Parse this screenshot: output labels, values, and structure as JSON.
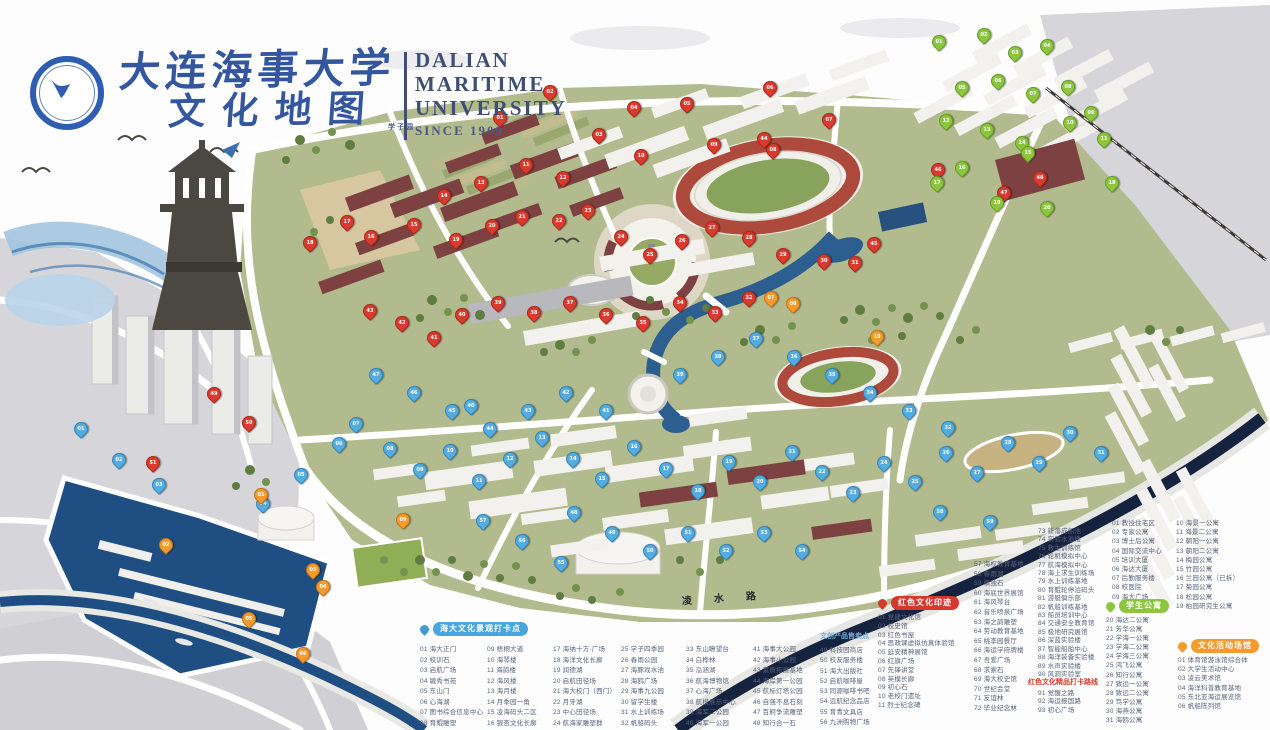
{
  "header": {
    "title_cn_1": "大连海事大学",
    "title_cn_2": "文化地图",
    "en1": "DALIAN",
    "en2": "MARITIME",
    "en3": "UNIVERSITY",
    "since": "SINCE 1909"
  },
  "map": {
    "road_label": "凌水路",
    "area_label": "学子园",
    "accent_colors": {
      "red_pin": "#d93b2f",
      "blue_pin": "#55ace0",
      "green_pin": "#8cc63f",
      "orange_pin": "#f59b2d",
      "water": "#2d5e90",
      "track": "#ad4a3c"
    },
    "pins": [
      {
        "t": "r",
        "x": 499,
        "y": 126
      },
      {
        "t": "r",
        "x": 549,
        "y": 100
      },
      {
        "t": "r",
        "x": 598,
        "y": 143
      },
      {
        "t": "r",
        "x": 633,
        "y": 116
      },
      {
        "t": "r",
        "x": 686,
        "y": 112
      },
      {
        "t": "r",
        "x": 769,
        "y": 96
      },
      {
        "t": "r",
        "x": 828,
        "y": 128
      },
      {
        "t": "r",
        "x": 772,
        "y": 158
      },
      {
        "t": "r",
        "x": 713,
        "y": 153
      },
      {
        "t": "r",
        "x": 640,
        "y": 164
      },
      {
        "t": "r",
        "x": 525,
        "y": 173
      },
      {
        "t": "r",
        "x": 562,
        "y": 186
      },
      {
        "t": "r",
        "x": 480,
        "y": 191
      },
      {
        "t": "r",
        "x": 443,
        "y": 204
      },
      {
        "t": "r",
        "x": 413,
        "y": 233
      },
      {
        "t": "r",
        "x": 370,
        "y": 245
      },
      {
        "t": "r",
        "x": 346,
        "y": 230
      },
      {
        "t": "r",
        "x": 309,
        "y": 251
      },
      {
        "t": "r",
        "x": 455,
        "y": 248
      },
      {
        "t": "r",
        "x": 491,
        "y": 234
      },
      {
        "t": "r",
        "x": 521,
        "y": 225
      },
      {
        "t": "r",
        "x": 558,
        "y": 229
      },
      {
        "t": "r",
        "x": 587,
        "y": 219
      },
      {
        "t": "r",
        "x": 620,
        "y": 245
      },
      {
        "t": "r",
        "x": 649,
        "y": 263
      },
      {
        "t": "r",
        "x": 681,
        "y": 249
      },
      {
        "t": "r",
        "x": 711,
        "y": 236
      },
      {
        "t": "r",
        "x": 748,
        "y": 246
      },
      {
        "t": "r",
        "x": 782,
        "y": 263
      },
      {
        "t": "r",
        "x": 823,
        "y": 269
      },
      {
        "t": "r",
        "x": 854,
        "y": 271
      },
      {
        "t": "r",
        "x": 748,
        "y": 306
      },
      {
        "t": "r",
        "x": 714,
        "y": 321
      },
      {
        "t": "r",
        "x": 679,
        "y": 311
      },
      {
        "t": "r",
        "x": 642,
        "y": 331
      },
      {
        "t": "r",
        "x": 605,
        "y": 323
      },
      {
        "t": "r",
        "x": 569,
        "y": 311
      },
      {
        "t": "r",
        "x": 533,
        "y": 321
      },
      {
        "t": "r",
        "x": 497,
        "y": 311
      },
      {
        "t": "r",
        "x": 461,
        "y": 323
      },
      {
        "t": "r",
        "x": 433,
        "y": 346
      },
      {
        "t": "r",
        "x": 401,
        "y": 331
      },
      {
        "t": "r",
        "x": 369,
        "y": 319
      },
      {
        "t": "r",
        "x": 763,
        "y": 147
      },
      {
        "t": "r",
        "x": 873,
        "y": 252
      },
      {
        "t": "r",
        "x": 937,
        "y": 178
      },
      {
        "t": "r",
        "x": 1003,
        "y": 201
      },
      {
        "t": "r",
        "x": 1039,
        "y": 186
      },
      {
        "t": "r",
        "x": 213,
        "y": 402
      },
      {
        "t": "r",
        "x": 248,
        "y": 431
      },
      {
        "t": "r",
        "x": 152,
        "y": 471
      },
      {
        "t": "b",
        "x": 80,
        "y": 437
      },
      {
        "t": "b",
        "x": 118,
        "y": 468
      },
      {
        "t": "b",
        "x": 158,
        "y": 493
      },
      {
        "t": "b",
        "x": 262,
        "y": 512
      },
      {
        "t": "b",
        "x": 300,
        "y": 483
      },
      {
        "t": "b",
        "x": 338,
        "y": 452
      },
      {
        "t": "b",
        "x": 355,
        "y": 432
      },
      {
        "t": "b",
        "x": 389,
        "y": 457
      },
      {
        "t": "b",
        "x": 419,
        "y": 478
      },
      {
        "t": "b",
        "x": 449,
        "y": 459
      },
      {
        "t": "b",
        "x": 478,
        "y": 489
      },
      {
        "t": "b",
        "x": 509,
        "y": 467
      },
      {
        "t": "b",
        "x": 541,
        "y": 446
      },
      {
        "t": "b",
        "x": 572,
        "y": 467
      },
      {
        "t": "b",
        "x": 601,
        "y": 487
      },
      {
        "t": "b",
        "x": 633,
        "y": 455
      },
      {
        "t": "b",
        "x": 665,
        "y": 477
      },
      {
        "t": "b",
        "x": 697,
        "y": 499
      },
      {
        "t": "b",
        "x": 728,
        "y": 470
      },
      {
        "t": "b",
        "x": 759,
        "y": 490
      },
      {
        "t": "b",
        "x": 791,
        "y": 460
      },
      {
        "t": "b",
        "x": 821,
        "y": 480
      },
      {
        "t": "b",
        "x": 852,
        "y": 501
      },
      {
        "t": "b",
        "x": 883,
        "y": 471
      },
      {
        "t": "b",
        "x": 914,
        "y": 490
      },
      {
        "t": "b",
        "x": 945,
        "y": 461
      },
      {
        "t": "b",
        "x": 976,
        "y": 481
      },
      {
        "t": "b",
        "x": 1007,
        "y": 451
      },
      {
        "t": "b",
        "x": 1038,
        "y": 471
      },
      {
        "t": "b",
        "x": 1069,
        "y": 441
      },
      {
        "t": "b",
        "x": 1100,
        "y": 461
      },
      {
        "t": "b",
        "x": 947,
        "y": 436
      },
      {
        "t": "b",
        "x": 908,
        "y": 419
      },
      {
        "t": "b",
        "x": 869,
        "y": 401
      },
      {
        "t": "b",
        "x": 831,
        "y": 383
      },
      {
        "t": "b",
        "x": 793,
        "y": 365
      },
      {
        "t": "b",
        "x": 755,
        "y": 347
      },
      {
        "t": "b",
        "x": 717,
        "y": 365
      },
      {
        "t": "b",
        "x": 679,
        "y": 383
      },
      {
        "t": "b",
        "x": 470,
        "y": 414
      },
      {
        "t": "b",
        "x": 605,
        "y": 419
      },
      {
        "t": "b",
        "x": 565,
        "y": 401
      },
      {
        "t": "b",
        "x": 527,
        "y": 419
      },
      {
        "t": "b",
        "x": 489,
        "y": 437
      },
      {
        "t": "b",
        "x": 451,
        "y": 419
      },
      {
        "t": "b",
        "x": 413,
        "y": 401
      },
      {
        "t": "b",
        "x": 375,
        "y": 383
      },
      {
        "t": "b",
        "x": 573,
        "y": 521
      },
      {
        "t": "b",
        "x": 611,
        "y": 541
      },
      {
        "t": "b",
        "x": 649,
        "y": 559
      },
      {
        "t": "b",
        "x": 687,
        "y": 541
      },
      {
        "t": "b",
        "x": 725,
        "y": 559
      },
      {
        "t": "b",
        "x": 763,
        "y": 541
      },
      {
        "t": "b",
        "x": 801,
        "y": 559
      },
      {
        "t": "b",
        "x": 560,
        "y": 571
      },
      {
        "t": "b",
        "x": 521,
        "y": 549
      },
      {
        "t": "b",
        "x": 482,
        "y": 529
      },
      {
        "t": "b",
        "x": 939,
        "y": 520
      },
      {
        "t": "b",
        "x": 989,
        "y": 530
      },
      {
        "t": "g",
        "x": 938,
        "y": 50
      },
      {
        "t": "g",
        "x": 983,
        "y": 43
      },
      {
        "t": "g",
        "x": 1014,
        "y": 61
      },
      {
        "t": "g",
        "x": 1046,
        "y": 54
      },
      {
        "t": "g",
        "x": 961,
        "y": 96
      },
      {
        "t": "g",
        "x": 997,
        "y": 89
      },
      {
        "t": "g",
        "x": 1032,
        "y": 102
      },
      {
        "t": "g",
        "x": 1067,
        "y": 95
      },
      {
        "t": "g",
        "x": 1090,
        "y": 121
      },
      {
        "t": "g",
        "x": 1069,
        "y": 131
      },
      {
        "t": "g",
        "x": 1103,
        "y": 147
      },
      {
        "t": "g",
        "x": 945,
        "y": 129
      },
      {
        "t": "g",
        "x": 986,
        "y": 138
      },
      {
        "t": "g",
        "x": 1021,
        "y": 151
      },
      {
        "t": "g",
        "x": 1027,
        "y": 161
      },
      {
        "t": "g",
        "x": 961,
        "y": 176
      },
      {
        "t": "g",
        "x": 936,
        "y": 191
      },
      {
        "t": "g",
        "x": 1111,
        "y": 191
      },
      {
        "t": "g",
        "x": 996,
        "y": 211
      },
      {
        "t": "g",
        "x": 1046,
        "y": 216
      },
      {
        "t": "o",
        "x": 260,
        "y": 503
      },
      {
        "t": "o",
        "x": 165,
        "y": 553
      },
      {
        "t": "o",
        "x": 312,
        "y": 578
      },
      {
        "t": "o",
        "x": 322,
        "y": 595
      },
      {
        "t": "o",
        "x": 248,
        "y": 627
      },
      {
        "t": "o",
        "x": 302,
        "y": 662
      },
      {
        "t": "o",
        "x": 770,
        "y": 306
      },
      {
        "t": "o",
        "x": 792,
        "y": 312
      },
      {
        "t": "o",
        "x": 402,
        "y": 528
      },
      {
        "t": "o",
        "x": 876,
        "y": 345
      }
    ]
  },
  "legend": {
    "blocks": [
      {
        "type": "badge",
        "style": "blue",
        "x": 420,
        "y": 622,
        "text": "海大文化景观打卡点"
      },
      {
        "type": "column",
        "x": 420,
        "y": 645,
        "lh": 10.5,
        "items": [
          "01 海大正门",
          "02 校训石",
          "03 启航广场",
          "04 毓秀书苑",
          "05 东山门",
          "06 心海湖",
          "07 图书综合信息中心",
          "08 育鲲雕塑"
        ]
      },
      {
        "type": "column",
        "x": 487,
        "y": 645,
        "lh": 10.5,
        "items": [
          "09 梧桐大道",
          "10 海琴楼",
          "11 海韵楼",
          "12 海风楼",
          "13 海月楼",
          "14 月季园一角",
          "15 凌海码头二区",
          "16 银杏文化长廊"
        ]
      },
      {
        "type": "column",
        "x": 553,
        "y": 645,
        "lh": 10.5,
        "items": [
          "17 海纳十方·广场",
          "18 海洋文化长廊",
          "19 润德湖",
          "20 启航田径场",
          "21 海大校门（西门）",
          "22 月牙湖",
          "23 中心田径场",
          "24 航海家雕塑群"
        ]
      },
      {
        "type": "column",
        "x": 621,
        "y": 645,
        "lh": 10.5,
        "items": [
          "25 学子四季园",
          "26 春雨公园",
          "27 海豚戏水池",
          "28 海鸥广场",
          "29 海事九公园",
          "30 留学生楼",
          "31 水上训练场",
          "32 帆船码头"
        ]
      },
      {
        "type": "column",
        "x": 686,
        "y": 645,
        "lh": 10.5,
        "items": [
          "33 东山瞭望台",
          "34 白桦林",
          "35 泓涵湖",
          "36 航海博物馆",
          "37 心海广场",
          "38 航模展示中心",
          "39 海军二公园",
          "40 海军一公园"
        ]
      },
      {
        "type": "column",
        "x": 753,
        "y": 645,
        "lh": 10.5,
        "items": [
          "41 海事大公园",
          "42 海事小公园",
          "43 素质拓展基地",
          "44 海岸第一公园",
          "45 航标灯塔公园",
          "46 自强不息石刻",
          "47 百舸争流雕塑",
          "48 知行合一石"
        ]
      },
      {
        "type": "subheader",
        "style": "blueText",
        "x": 820,
        "y": 633,
        "text": "文创产品售卖点"
      },
      {
        "type": "column",
        "x": 820,
        "y": 646,
        "lh": 10.3,
        "items": [
          "49 科技园商店",
          "50 校友服务楼",
          "51 海大出版社",
          "52 启航咖啡屋",
          "53 同源咖啡书吧",
          "54 远航纪念品店",
          "55 育青文具店",
          "56 九洲购物广场"
        ]
      },
      {
        "type": "column",
        "x": 974,
        "y": 560,
        "lh": 9.6,
        "items": [
          "57 海权教育基地",
          "58 春雨湖",
          "59 慎独石",
          "60 海底世界展馆",
          "61 海风琴台",
          "62 音乐喷泉广场",
          "63 海之韵雕塑",
          "64 劳动教育基地",
          "65 桃李园餐厅",
          "66 海运学府牌楼",
          "67 吾爱广场",
          "68 求索石",
          "69 海大校史馆",
          "70 世纪会堂",
          "71 友谊林",
          "72 毕业纪念林"
        ]
      },
      {
        "type": "column",
        "x": 1038,
        "y": 528,
        "lh": 8.4,
        "items": [
          "73 新落成船池",
          "74 实验水池楼",
          "75 救生训练馆",
          "76 轮机模拟中心",
          "77 航海模拟中心",
          "78 海上求生训练场",
          "79 水上训练基地",
          "80 育鲲轮停泊码头",
          "81 游艇俱乐部",
          "82 帆船训练基地",
          "83 船员培训中心",
          "84 交通安全教育馆",
          "85 极地研究展馆",
          "86 深蓝实验楼",
          "87 智能船舶中心",
          "88 海洋装备实验楼",
          "89 水声实验楼",
          "90 风洞实验室"
        ]
      },
      {
        "type": "subheader",
        "style": "redText",
        "x": 1028,
        "y": 679,
        "text": "红色文化精品打卡路线"
      },
      {
        "type": "column",
        "x": 1038,
        "y": 690,
        "lh": 8.3,
        "items": [
          "91 觉醒之路",
          "92 海运报国路",
          "93 初心广场"
        ]
      },
      {
        "type": "badge",
        "style": "red",
        "x": 878,
        "y": 596,
        "text": "红色文化印迹"
      },
      {
        "type": "column",
        "x": 878,
        "y": 614,
        "lh": 8.8,
        "items": [
          "01 党建文化馆",
          "02 校史馆",
          "03 红色书屋",
          "04 思政课虚拟仿真体验馆",
          "05 延安精神展馆",
          "06 红旗广场",
          "07 先锋讲堂",
          "08 英模长廊",
          "09 初心石",
          "10 老校门遗址",
          "11 烈士纪念碑"
        ]
      },
      {
        "type": "column",
        "x": 1112,
        "y": 519,
        "lh": 9.2,
        "items": [
          "01 教授住宅区",
          "02 专家公寓",
          "03 博士后公寓",
          "04 国际交流中心",
          "05 培训大厦",
          "06 海达大厦",
          "07 后勤服务楼",
          "08 校医院",
          "09 海大广场"
        ]
      },
      {
        "type": "column",
        "x": 1176,
        "y": 519,
        "lh": 9.2,
        "items": [
          "10 海景一公寓",
          "11 海景二公寓",
          "12 朝阳一公寓",
          "13 朝阳二公寓",
          "14 梅园公寓",
          "15 竹园公寓",
          "16 兰园公寓（已拆）",
          "17 菊园公寓",
          "18 松园公寓",
          "19 柏园研究生公寓"
        ]
      },
      {
        "type": "badge",
        "style": "green",
        "x": 1106,
        "y": 599,
        "text": "学生公寓"
      },
      {
        "type": "column",
        "x": 1106,
        "y": 616,
        "lh": 9.1,
        "items": [
          "20 海达二公寓",
          "21 芳华公寓",
          "22 学海一公寓",
          "23 学海二公寓",
          "24 学海三公寓",
          "25 鸿飞公寓",
          "26 知行公寓",
          "27 致远一公寓",
          "28 致远二公寓",
          "29 笃学公寓",
          "30 海燕公寓",
          "31 海鸥公寓"
        ]
      },
      {
        "type": "badge",
        "style": "orange",
        "x": 1178,
        "y": 639,
        "text": "文化活动场馆"
      },
      {
        "type": "column",
        "x": 1178,
        "y": 656,
        "lh": 9.2,
        "items": [
          "01 体育馆游泳馆综合体",
          "02 大学生活动中心",
          "03 凌云美术馆",
          "04 海洋科普教育基地",
          "05 东北亚海运展览馆",
          "06 帆船陈列馆"
        ]
      }
    ]
  }
}
